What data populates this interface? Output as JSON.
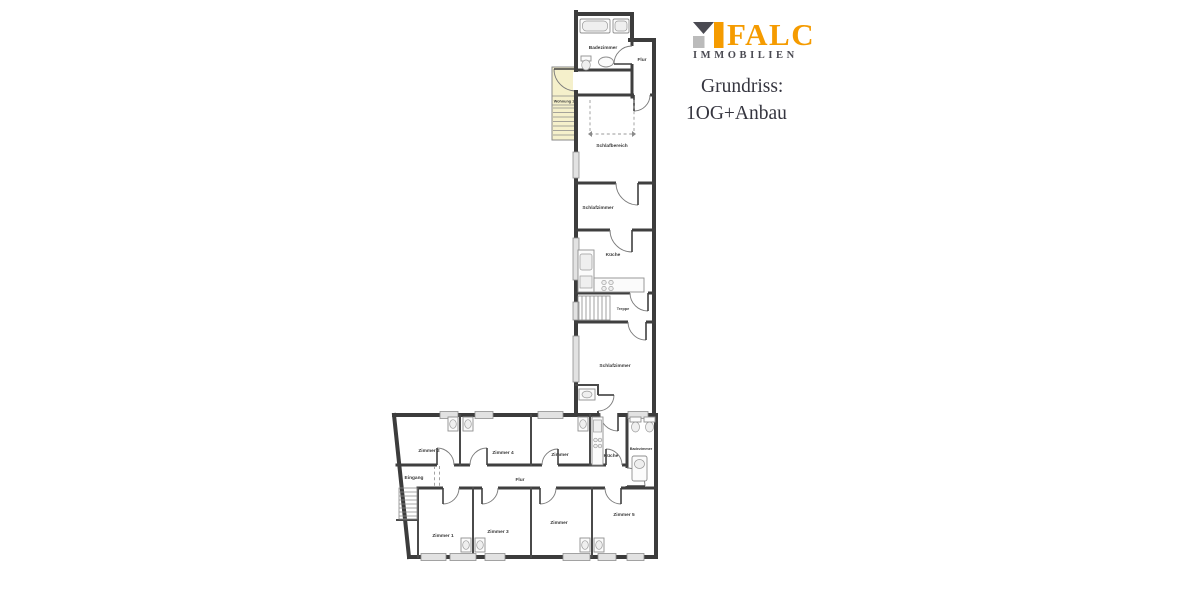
{
  "branding": {
    "logo_text": "FALC",
    "logo_subtext": "IMMOBILIEN",
    "title_line1": "Grundriss:",
    "title_line2": "1OG+Anbau",
    "colors": {
      "orange": "#F59B00",
      "dark_gray": "#4A4A52",
      "light_gray": "#BBBBBB",
      "title_text": "#35353F"
    }
  },
  "floorplan": {
    "wall_color": "#3C3C3C",
    "stair_accent": "#F5F0CB",
    "og": {
      "badezimmer": "Badezimmer",
      "flur": "Flur",
      "wohnung": "Wohnung 1",
      "schlafbereich": "Schlafbereich",
      "schlafzimmer": "Schlafzimmer",
      "kueche": "Küche",
      "treppe": "Treppe",
      "schlafzimmer_gross": "Schlafzimmer"
    },
    "anbau": {
      "zimmer2": "Zimmer 2",
      "zimmer4": "Zimmer 4",
      "zimmer_oben": "Zimmer",
      "kueche": "Küche",
      "badezimmer": "Badezimmer",
      "eingang": "Eingang",
      "flur": "Flur",
      "zimmer1": "Zimmer 1",
      "zimmer3": "Zimmer 3",
      "zimmer_unten": "Zimmer",
      "zimmer5": "Zimmer 5"
    }
  }
}
